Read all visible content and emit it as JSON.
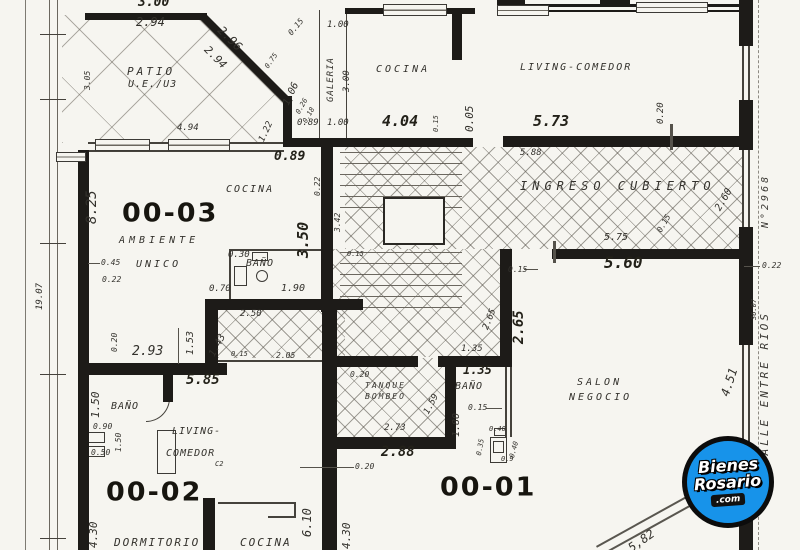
{
  "units": {
    "u1": "00-01",
    "u2": "00-02",
    "u3": "00-03"
  },
  "labels": {
    "patio1": "PATIO",
    "patio2": "U.E./U3",
    "galeria": "GALERIA",
    "cocina_top": "COCINA",
    "living_top": "LIVING-COMEDOR",
    "ingreso": "INGRESO  CUBIERTO",
    "cocina_u3": "COCINA",
    "ambiente": "AMBIENTE",
    "unico": "UNICO",
    "banio_u3": "BAÑO",
    "banio_u2": "BAÑO",
    "living_u2a": "LIVING-",
    "living_u2b": "COMEDOR",
    "dormitorio": "DORMITORIO",
    "cocina_u2": "COCINA",
    "c2": "C2",
    "tanque1": "TANQUE",
    "tanque2": "BOMBEO",
    "banio_u1": "BAÑO",
    "salon1": "SALON",
    "salon2": "NEGOCIO"
  },
  "street": {
    "name": "CALLE ENTRE RIOS",
    "number": "N°2968",
    "side_length": "19.07",
    "front_length": "36.07"
  },
  "logo": {
    "line1": "Bienes",
    "line2": "Rosario",
    "line3": ".com",
    "bg_color": "#1793ea",
    "ring_color": "#0c0c0c"
  },
  "dims": [
    {
      "t": "3.00",
      "x": 138,
      "y": -4,
      "s": 13,
      "b": 1
    },
    {
      "t": "2.94",
      "x": 136,
      "y": 16,
      "s": 12
    },
    {
      "t": "0.15",
      "x": 287,
      "y": 32,
      "r": -50,
      "s": 8
    },
    {
      "t": "2.96",
      "x": 224,
      "y": 24,
      "r": 45,
      "s": 12
    },
    {
      "t": "2.94",
      "x": 210,
      "y": 44,
      "r": 45,
      "s": 11
    },
    {
      "t": "0.75",
      "x": 264,
      "y": 66,
      "r": -55,
      "s": 7
    },
    {
      "t": "1.06",
      "x": 282,
      "y": 103,
      "r": -65,
      "s": 10
    },
    {
      "t": "1.22",
      "x": 258,
      "y": 140,
      "r": -65,
      "s": 9
    },
    {
      "t": "0.26",
      "x": 295,
      "y": 112,
      "r": -60,
      "s": 7
    },
    {
      "t": "0.18",
      "x": 302,
      "y": 121,
      "r": -60,
      "s": 7
    },
    {
      "t": "3.05",
      "x": 84,
      "y": 90,
      "r": -90,
      "s": 8
    },
    {
      "t": "4.94",
      "x": 177,
      "y": 124,
      "s": 9
    },
    {
      "t": "8.25",
      "x": 85,
      "y": 224,
      "r": -90,
      "s": 14
    },
    {
      "t": "1.00",
      "x": 327,
      "y": 21,
      "s": 9
    },
    {
      "t": "3.00",
      "x": 343,
      "y": 92,
      "r": -90,
      "s": 9
    },
    {
      "t": "1.00",
      "x": 327,
      "y": 119,
      "s": 9
    },
    {
      "t": "0.89",
      "x": 297,
      "y": 119,
      "s": 9
    },
    {
      "t": "4.04",
      "x": 382,
      "y": 114,
      "s": 15,
      "b": 1
    },
    {
      "t": "0.15",
      "x": 433,
      "y": 132,
      "r": -90,
      "s": 7
    },
    {
      "t": "0.05",
      "x": 464,
      "y": 132,
      "r": -90,
      "s": 11
    },
    {
      "t": "5.73",
      "x": 533,
      "y": 114,
      "s": 15,
      "b": 1
    },
    {
      "t": "0.20",
      "x": 657,
      "y": 124,
      "r": -90,
      "s": 9
    },
    {
      "t": "5.88",
      "x": 520,
      "y": 149,
      "s": 9
    },
    {
      "t": "0.89",
      "x": 274,
      "y": 150,
      "s": 13,
      "b": 1
    },
    {
      "t": "0.22",
      "x": 314,
      "y": 196,
      "r": -90,
      "s": 8
    },
    {
      "t": "2.60",
      "x": 714,
      "y": 208,
      "r": -60,
      "s": 10
    },
    {
      "t": "0.15",
      "x": 656,
      "y": 230,
      "r": -60,
      "s": 8
    },
    {
      "t": "5.75",
      "x": 604,
      "y": 233,
      "s": 10
    },
    {
      "t": "5.60",
      "x": 604,
      "y": 255,
      "s": 16,
      "b": 1
    },
    {
      "t": "0.22",
      "x": 762,
      "y": 262,
      "s": 8
    },
    {
      "t": "36.07",
      "x": 751,
      "y": 320,
      "r": -90,
      "s": 7
    },
    {
      "t": "3.50",
      "x": 296,
      "y": 258,
      "r": -90,
      "s": 15,
      "b": 1
    },
    {
      "t": "0.30",
      "x": 228,
      "y": 251,
      "s": 9
    },
    {
      "t": "0.45",
      "x": 101,
      "y": 259,
      "s": 8
    },
    {
      "t": "0.22",
      "x": 102,
      "y": 276,
      "s": 8
    },
    {
      "t": "0.70",
      "x": 209,
      "y": 285,
      "s": 9
    },
    {
      "t": "1.90",
      "x": 281,
      "y": 284,
      "s": 10
    },
    {
      "t": "2.50",
      "x": 240,
      "y": 310,
      "s": 9
    },
    {
      "t": "3.42",
      "x": 334,
      "y": 232,
      "r": -90,
      "s": 8
    },
    {
      "t": "0.15",
      "x": 347,
      "y": 251,
      "s": 7
    },
    {
      "t": "1.53",
      "x": 186,
      "y": 355,
      "r": -90,
      "s": 10
    },
    {
      "t": "1.43",
      "x": 208,
      "y": 354,
      "r": -62,
      "s": 10
    },
    {
      "t": "0.20",
      "x": 111,
      "y": 352,
      "r": -90,
      "s": 8
    },
    {
      "t": "2.93",
      "x": 132,
      "y": 345,
      "s": 13
    },
    {
      "t": "0.15",
      "x": 231,
      "y": 351,
      "s": 7
    },
    {
      "t": "2.05",
      "x": 276,
      "y": 352,
      "s": 8
    },
    {
      "t": "5.85",
      "x": 186,
      "y": 373,
      "s": 14,
      "b": 1
    },
    {
      "t": "2.65",
      "x": 482,
      "y": 328,
      "r": -68,
      "s": 9
    },
    {
      "t": "2.65",
      "x": 512,
      "y": 344,
      "r": -90,
      "s": 14,
      "b": 1
    },
    {
      "t": "0.15",
      "x": 508,
      "y": 266,
      "s": 8
    },
    {
      "t": "1.35",
      "x": 461,
      "y": 345,
      "s": 9
    },
    {
      "t": "1.35",
      "x": 463,
      "y": 364,
      "s": 12,
      "b": 1
    },
    {
      "t": "0.15",
      "x": 468,
      "y": 404,
      "s": 8
    },
    {
      "t": "1.80",
      "x": 452,
      "y": 437,
      "r": -90,
      "s": 10
    },
    {
      "t": "1.59",
      "x": 423,
      "y": 412,
      "r": -62,
      "s": 9
    },
    {
      "t": "0.20",
      "x": 350,
      "y": 371,
      "s": 8
    },
    {
      "t": "2.73",
      "x": 384,
      "y": 424,
      "s": 9
    },
    {
      "t": "2.88",
      "x": 381,
      "y": 445,
      "s": 14,
      "b": 1
    },
    {
      "t": "0.20",
      "x": 355,
      "y": 463,
      "s": 8
    },
    {
      "t": "0.40",
      "x": 489,
      "y": 426,
      "s": 7
    },
    {
      "t": "0.35",
      "x": 476,
      "y": 455,
      "r": -80,
      "s": 7
    },
    {
      "t": "0.40",
      "x": 509,
      "y": 457,
      "r": -75,
      "s": 7
    },
    {
      "t": "0.9",
      "x": 501,
      "y": 456,
      "s": 7
    },
    {
      "t": "1.50",
      "x": 90,
      "y": 418,
      "r": -90,
      "s": 11
    },
    {
      "t": "0.90",
      "x": 93,
      "y": 423,
      "s": 8
    },
    {
      "t": "1.50",
      "x": 115,
      "y": 452,
      "r": -90,
      "s": 8
    },
    {
      "t": "0.50",
      "x": 91,
      "y": 449,
      "s": 8
    },
    {
      "t": "4.30",
      "x": 88,
      "y": 548,
      "r": -90,
      "s": 11
    },
    {
      "t": "6.10",
      "x": 301,
      "y": 537,
      "r": -90,
      "s": 12
    },
    {
      "t": "4.30",
      "x": 341,
      "y": 549,
      "r": -90,
      "s": 11
    },
    {
      "t": "4.51",
      "x": 719,
      "y": 394,
      "r": -72,
      "s": 12
    },
    {
      "t": "5,82",
      "x": 626,
      "y": 544,
      "r": -35,
      "s": 12
    },
    {
      "t": "19.07",
      "x": 36,
      "y": 310,
      "r": -90,
      "s": 9
    }
  ]
}
